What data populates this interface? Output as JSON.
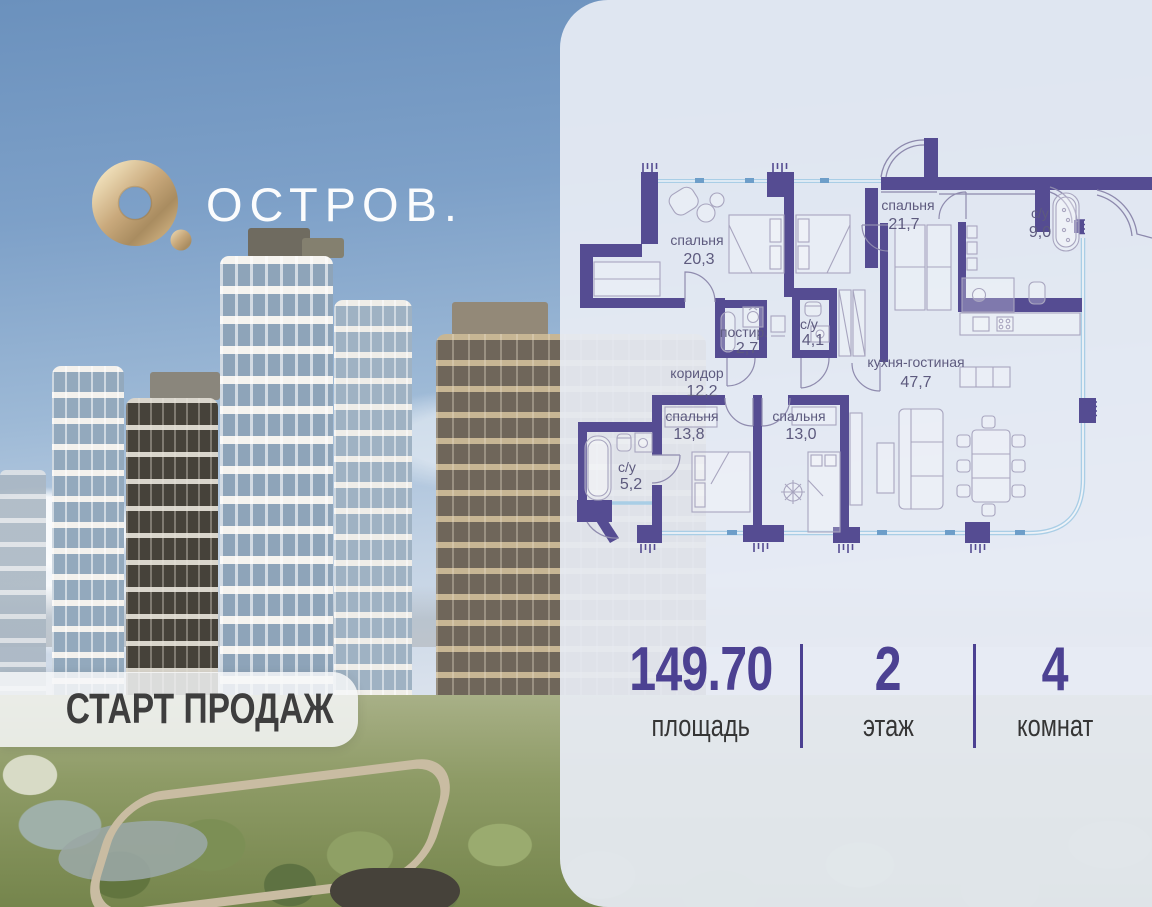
{
  "brand": {
    "name": "ОСТРОВ."
  },
  "badge": {
    "label": "СТАРТ ПРОДАЖ"
  },
  "plan": {
    "rooms": [
      {
        "name": "спальня",
        "area": "20,3"
      },
      {
        "name": "спальня",
        "area": "21,7"
      },
      {
        "name": "с/у",
        "area": "9,0"
      },
      {
        "name": "постир.",
        "area": "2,7"
      },
      {
        "name": "с/у",
        "area": "4,1"
      },
      {
        "name": "коридор",
        "area": "12,2"
      },
      {
        "name": "кухня-гостиная",
        "area": "47,7"
      },
      {
        "name": "спальня",
        "area": "13,8"
      },
      {
        "name": "спальня",
        "area": "13,0"
      },
      {
        "name": "с/у",
        "area": "5,2"
      }
    ]
  },
  "stats": {
    "items": [
      {
        "value": "149.70",
        "label": "площадь"
      },
      {
        "value": "2",
        "label": "этаж"
      },
      {
        "value": "4",
        "label": "комнат"
      }
    ]
  },
  "colors": {
    "accent": "#4C4192",
    "wall": "#554C92",
    "gold": "#C9A97C",
    "window": "#A9CEE6"
  }
}
